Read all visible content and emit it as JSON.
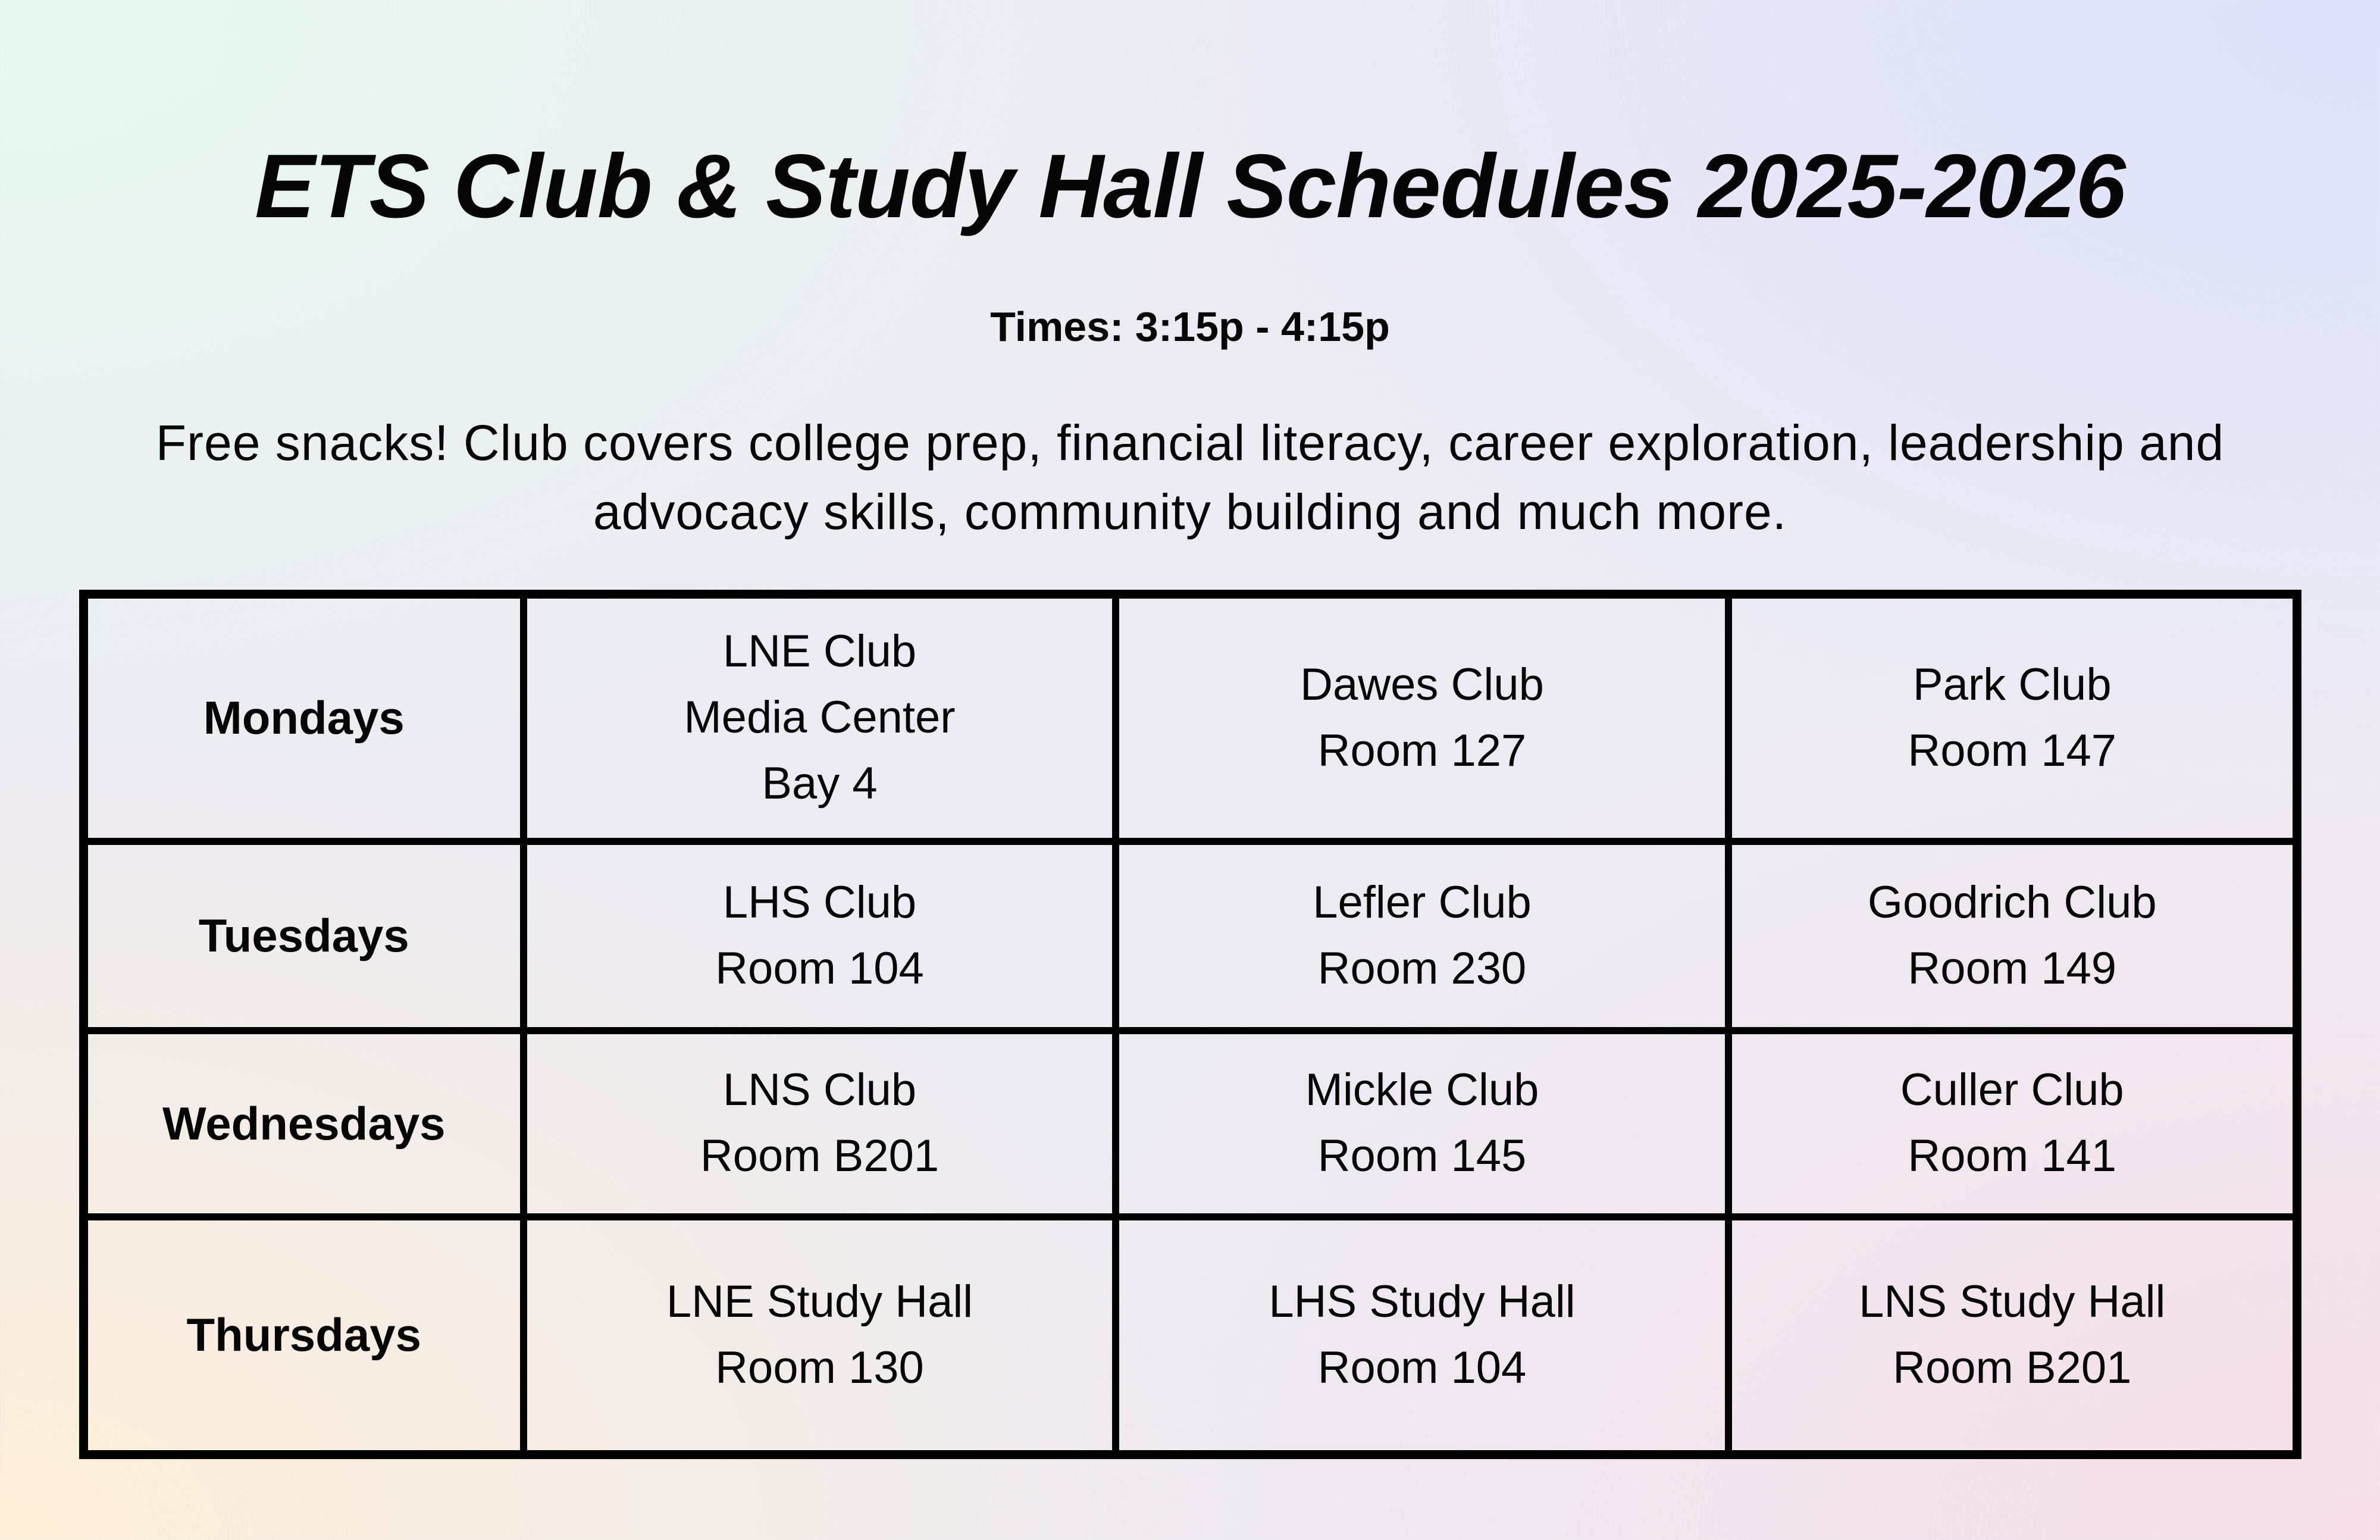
{
  "header": {
    "title": "ETS Club & Study Hall Schedules 2025-2026",
    "times_label": "Times: 3:15p - 4:15p",
    "intro_line1": "Free snacks! Club covers college prep, financial literacy, career exploration, leadership and",
    "intro_line2": "advocacy skills, community building and much more."
  },
  "colors": {
    "corner_top_left": "#e7f9ef",
    "corner_top_right": "#dee1fb",
    "corner_bottom_left": "#fdeed8",
    "corner_bottom_right": "#f6dfe9",
    "text": "#060606",
    "table_border": "#000000"
  },
  "schedule": {
    "rows": [
      {
        "day": "Mondays",
        "cells": [
          [
            "LNE Club",
            "Media Center",
            "Bay 4"
          ],
          [
            "Dawes Club",
            "Room 127"
          ],
          [
            "Park Club",
            "Room 147"
          ]
        ]
      },
      {
        "day": "Tuesdays",
        "cells": [
          [
            "LHS Club",
            "Room 104"
          ],
          [
            "Lefler Club",
            "Room 230"
          ],
          [
            "Goodrich Club",
            "Room 149"
          ]
        ]
      },
      {
        "day": "Wednesdays",
        "cells": [
          [
            "LNS Club",
            "Room B201"
          ],
          [
            "Mickle Club",
            "Room 145"
          ],
          [
            "Culler Club",
            "Room 141"
          ]
        ]
      },
      {
        "day": "Thursdays",
        "cells": [
          [
            "LNE Study Hall",
            "Room 130"
          ],
          [
            "LHS Study Hall",
            "Room 104"
          ],
          [
            "LNS Study Hall",
            "Room B201"
          ]
        ]
      }
    ]
  }
}
